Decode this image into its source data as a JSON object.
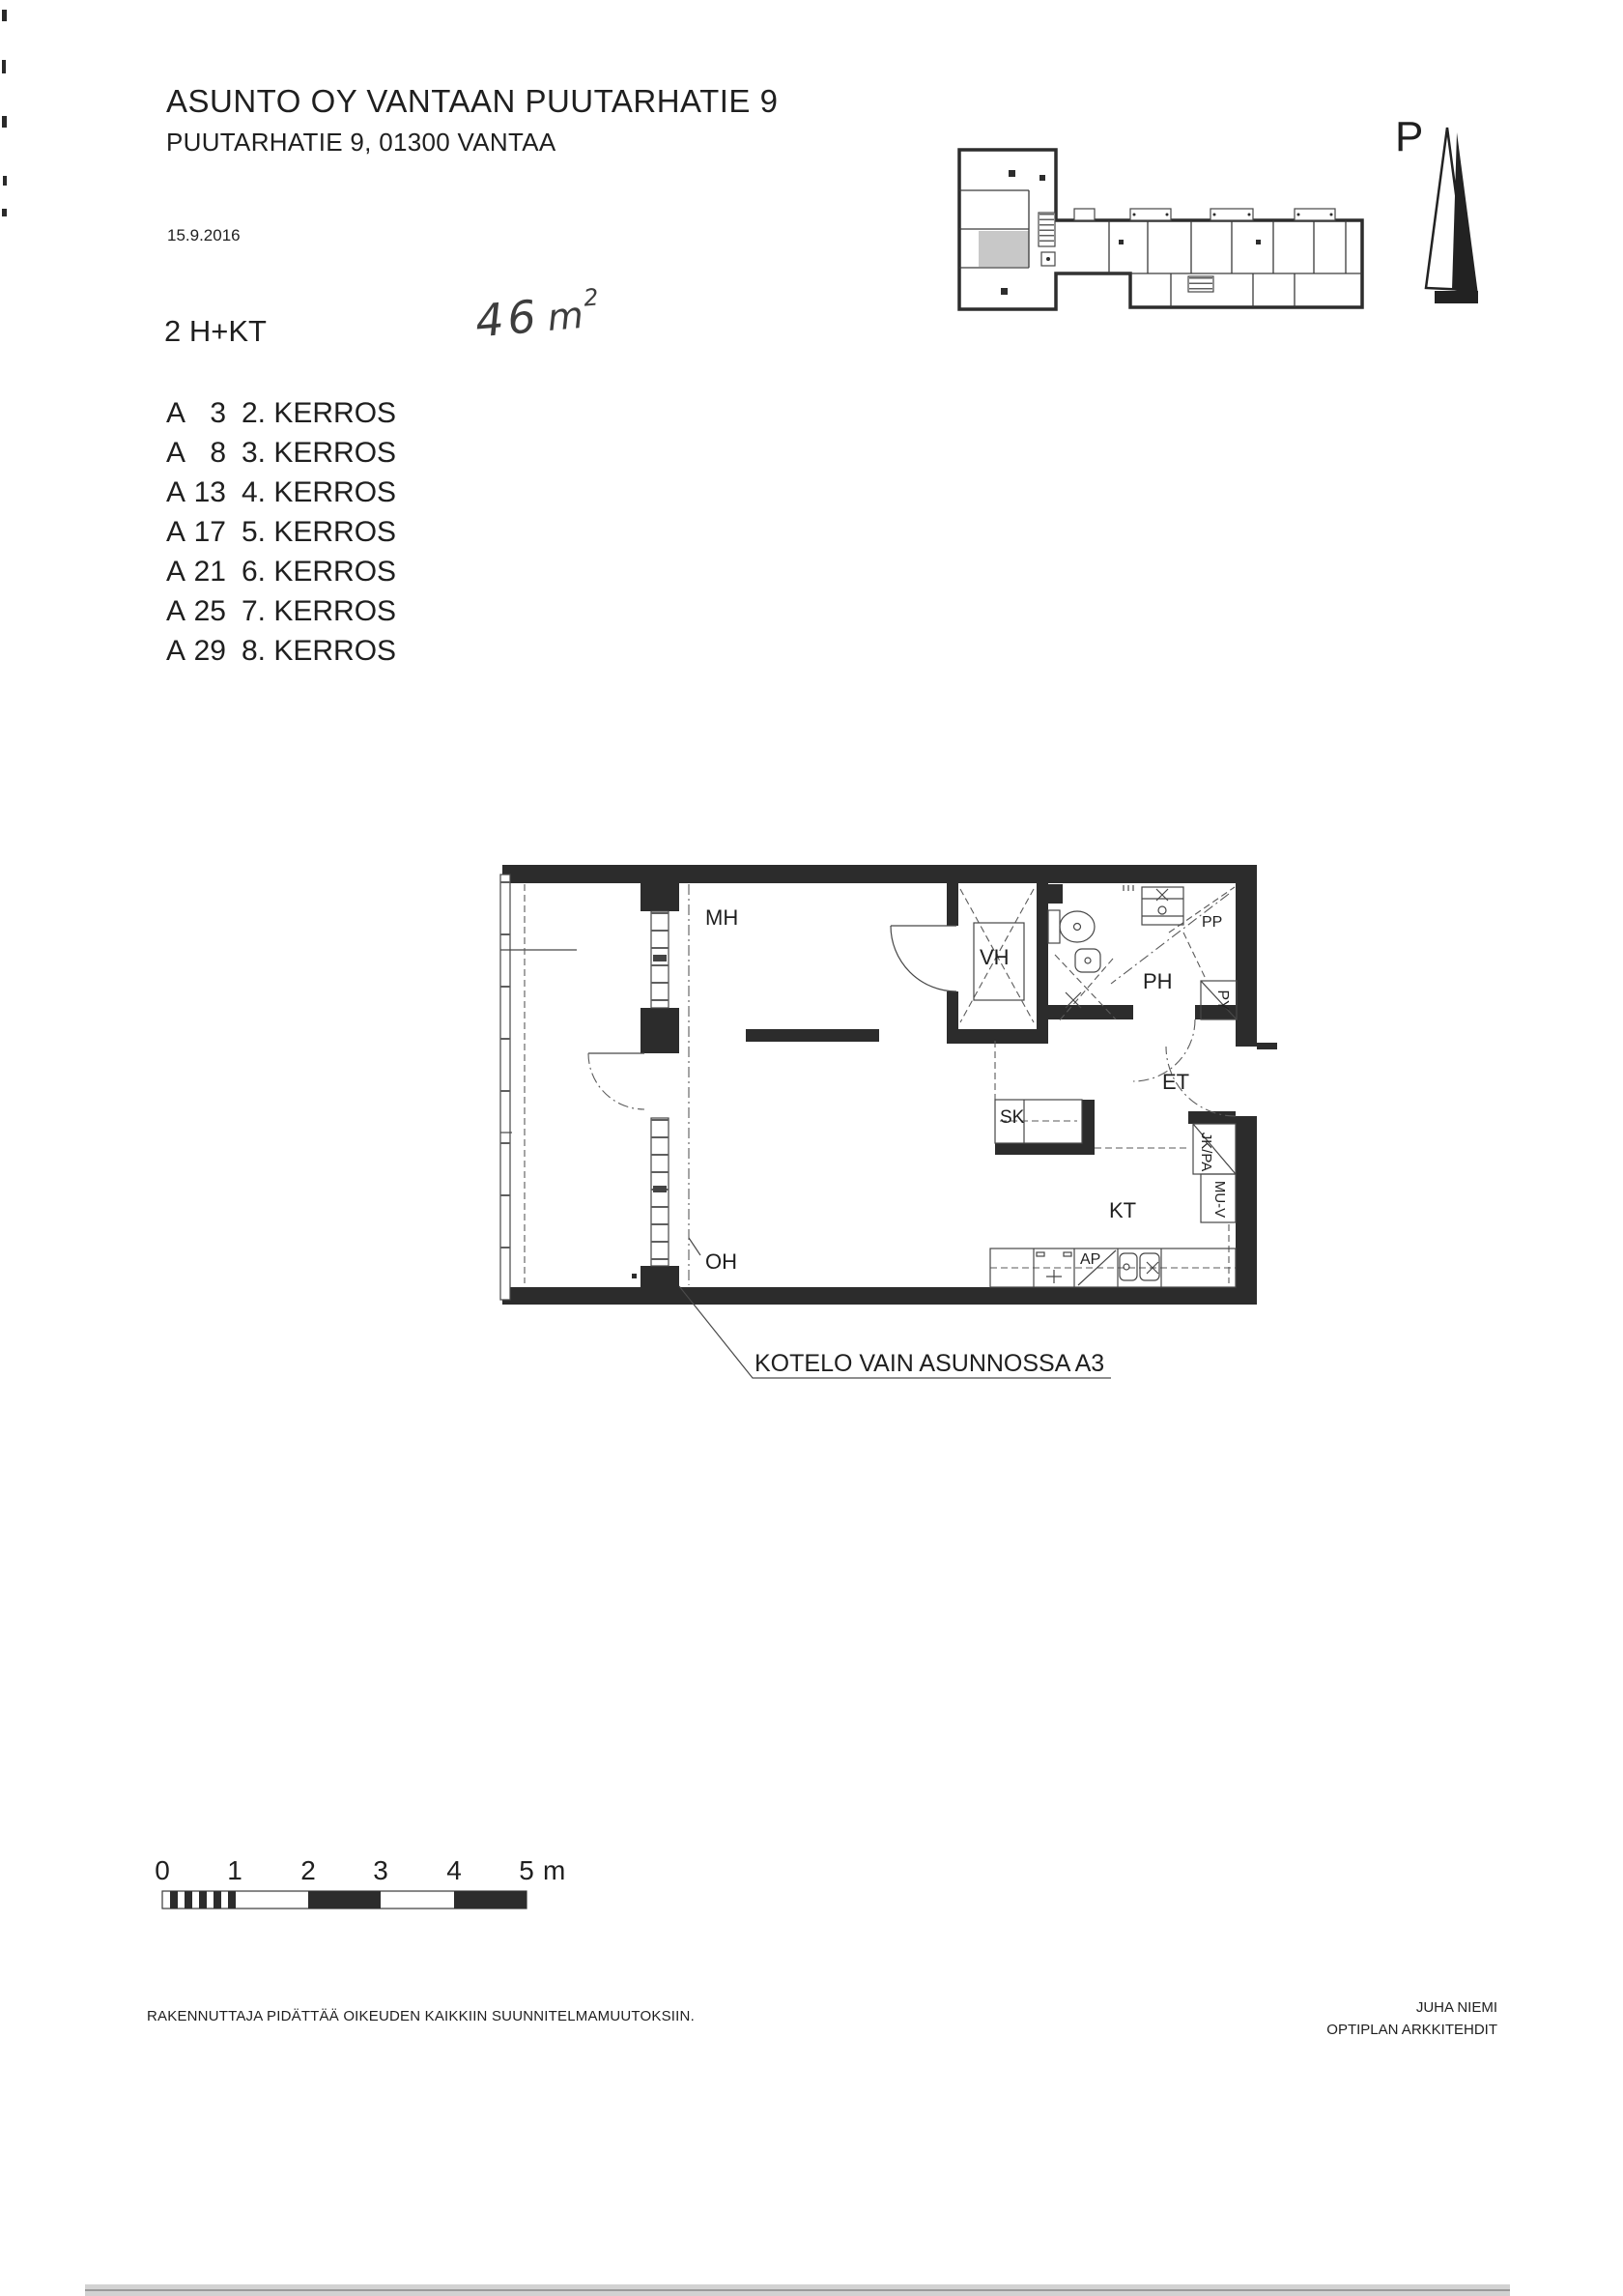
{
  "document": {
    "title": "ASUNTO OY VANTAAN PUUTARHATIE 9",
    "address": "PUUTARHATIE 9, 01300 VANTAA",
    "date": "15.9.2016"
  },
  "apartment": {
    "type": "2 H+KT",
    "area_value": "46",
    "area_unit": "m",
    "area_superscript": "2"
  },
  "floor_list": [
    {
      "letter": "A",
      "number": "3",
      "floor": "2. KERROS"
    },
    {
      "letter": "A",
      "number": "8",
      "floor": "3. KERROS"
    },
    {
      "letter": "A",
      "number": "13",
      "floor": "4. KERROS"
    },
    {
      "letter": "A",
      "number": "17",
      "floor": "5. KERROS"
    },
    {
      "letter": "A",
      "number": "21",
      "floor": "6. KERROS"
    },
    {
      "letter": "A",
      "number": "25",
      "floor": "7. KERROS"
    },
    {
      "letter": "A",
      "number": "29",
      "floor": "8. KERROS"
    }
  ],
  "north_arrow": {
    "label": "P"
  },
  "plan": {
    "rooms": {
      "mh": "MH",
      "vh": "VH",
      "ph": "PH",
      "et": "ET",
      "sk": "SK",
      "kt": "KT",
      "oh": "OH"
    },
    "labels": {
      "pp": "PP",
      "py": "PY",
      "jkpa": "JK/PA",
      "muv": "MU-V",
      "ap": "AP"
    },
    "note": "KOTELO VAIN ASUNNOSSA A3"
  },
  "scale_bar": {
    "ticks": [
      "0",
      "1",
      "2",
      "3",
      "4",
      "5"
    ],
    "unit": "m"
  },
  "footer": {
    "disclaimer": "RAKENNUTTAJA PIDÄTTÄÄ OIKEUDEN KAIKKIIN SUUNNITELMAMUUTOKSIIN.",
    "signature_name": "JUHA NIEMI",
    "signature_company": "OPTIPLAN ARKKITEHDIT"
  },
  "colors": {
    "ink": "#1f1f1f",
    "wall": "#2c2c2c",
    "highlight": "#c8c8c8",
    "paper": "#ffffff"
  }
}
